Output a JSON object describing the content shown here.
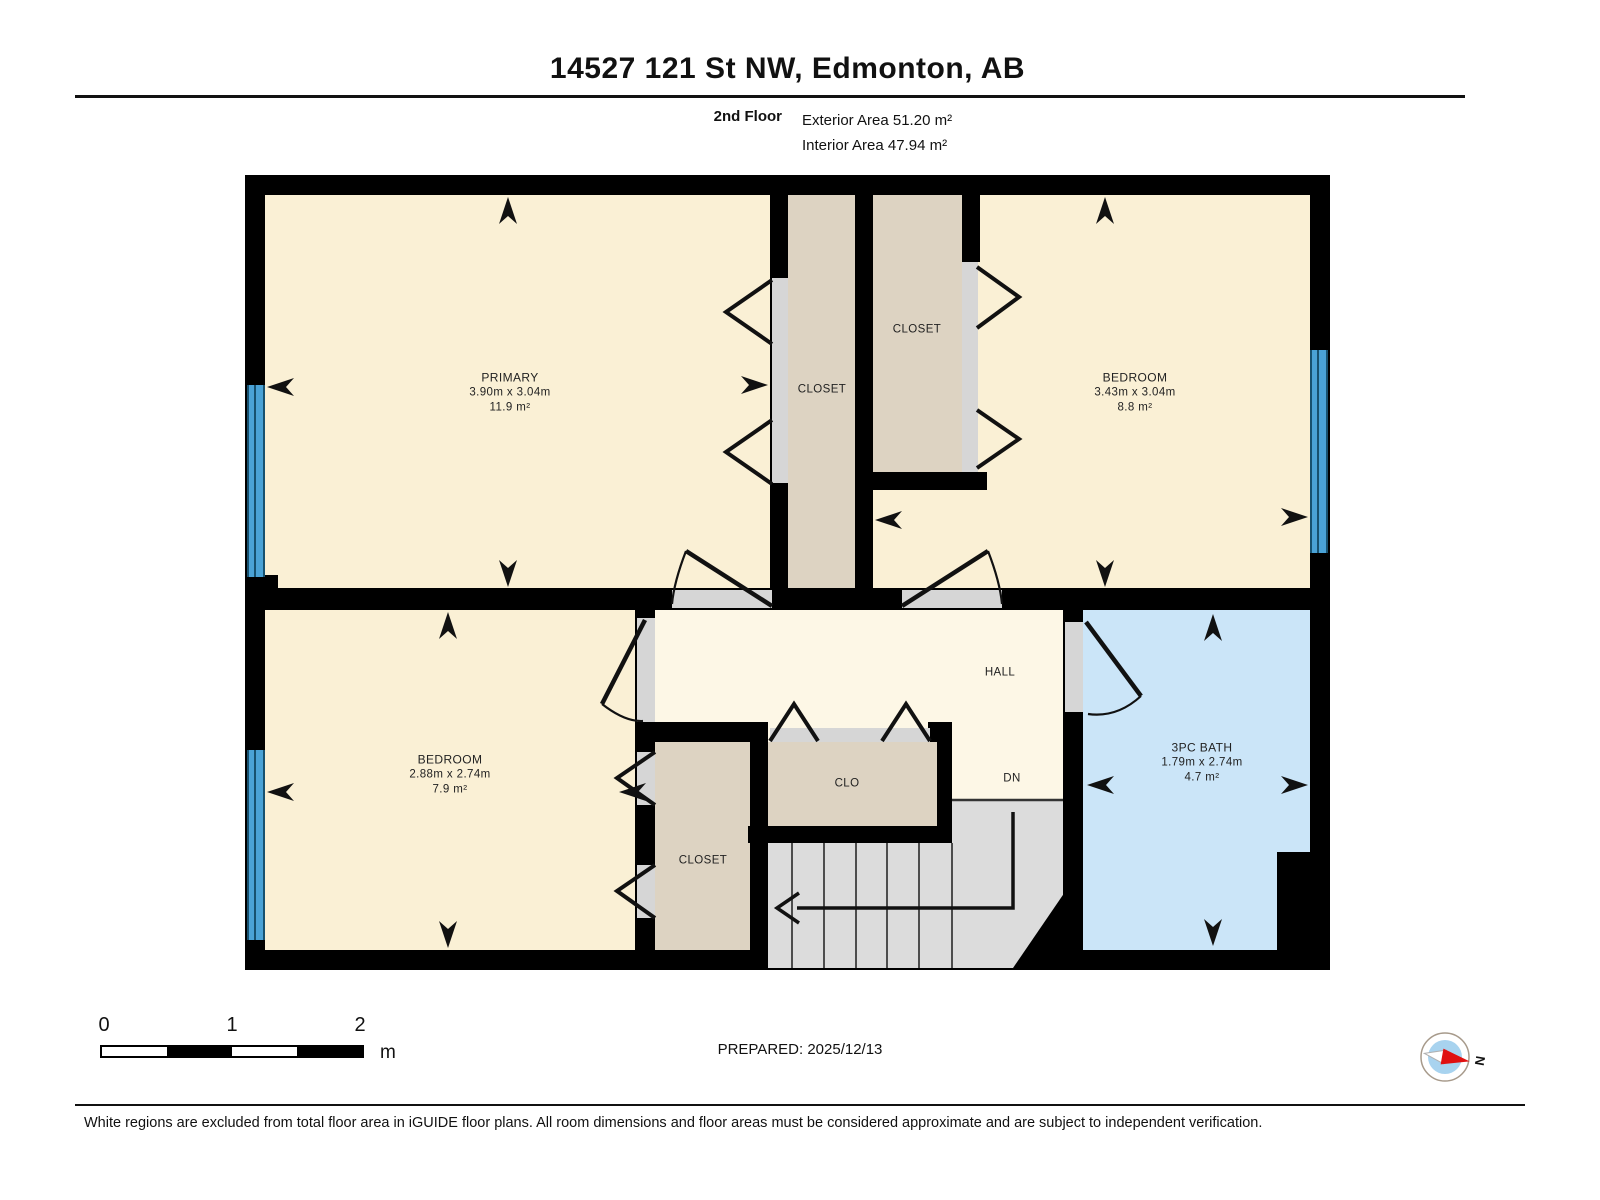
{
  "title": "14527 121 St NW, Edmonton, AB",
  "floor_info": {
    "floor": "2nd Floor",
    "exterior_area": "Exterior Area 51.20 m²",
    "interior_area": "Interior Area 47.94 m²"
  },
  "rooms": {
    "primary": {
      "name": "PRIMARY",
      "dimensions": "3.90m x 3.04m",
      "area": "11.9 m²"
    },
    "bedroom_right": {
      "name": "BEDROOM",
      "dimensions": "3.43m x 3.04m",
      "area": "8.8 m²"
    },
    "bedroom_left": {
      "name": "BEDROOM",
      "dimensions": "2.88m x 2.74m",
      "area": "7.9 m²"
    },
    "bath": {
      "name": "3PC BATH",
      "dimensions": "1.79m x 2.74m",
      "area": "4.7 m²"
    },
    "closet_middle": {
      "name": "CLOSET"
    },
    "closet_top": {
      "name": "CLOSET"
    },
    "closet_bottom": {
      "name": "CLOSET"
    },
    "clo": {
      "name": "CLO"
    },
    "hall": {
      "name": "HALL"
    },
    "dn_label": "DN"
  },
  "scale_bar": {
    "labels": [
      "0",
      "1",
      "2"
    ],
    "unit": "m"
  },
  "prepared": "PREPARED: 2025/12/13",
  "compass": {
    "north_label": "N"
  },
  "footer": "White regions are excluded from total floor area in iGUIDE floor plans. All room dimensions and floor areas must be considered approximate and are subject to independent verification.",
  "colors": {
    "room_cream": "#faf0d5",
    "hall_cream": "#fdf7e6",
    "closet_tan": "#ddd3c2",
    "stairs_gray": "#dcdcdc",
    "bath_blue": "#cbe5f8",
    "window_blue": "#4aa2d6",
    "wall_black": "#000000"
  }
}
